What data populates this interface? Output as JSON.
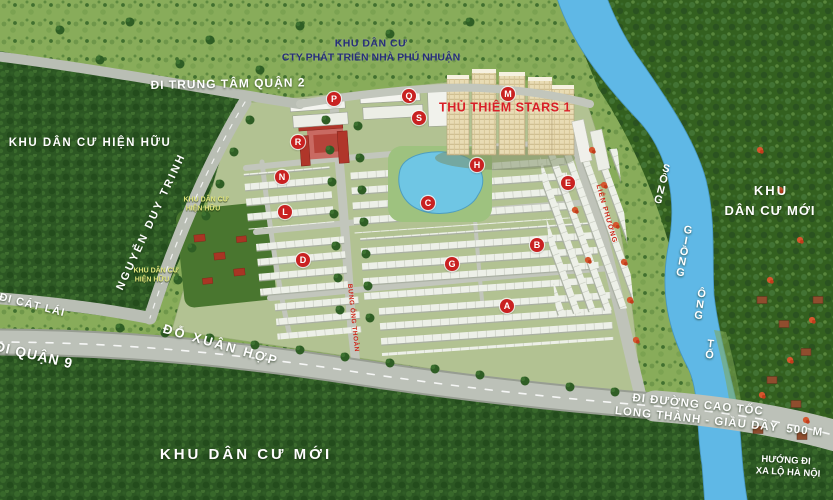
{
  "colors": {
    "marker_red": "#c92121",
    "river_blue": "#5fb8e6",
    "label_white": "#ffffff",
    "label_navy": "#272e7a",
    "label_yellow": "#e2e67c",
    "project_red": "#d81f26",
    "road_gray": "#bdc1ba",
    "forest_green": "#2c5723",
    "grass_green": "#88ac5a"
  },
  "labels": {
    "top_area_line1": "KHU DÂN CƯ",
    "top_area_line2": "CTY PHÁT TRIỂN NHÀ PHÚ NHUẬN",
    "to_district2": "ĐI TRUNG TÂM QUẬN 2",
    "existing_left": "KHU DÂN CƯ HIỆN HỮU",
    "nguyen_duy_trinh": "NGUYỄN DUY TRINH",
    "existing_small_1a": "KHU DÂN CƯ",
    "existing_small_1b": "HIỆN HỮU",
    "existing_small_2a": "KHU DÂN CƯ",
    "existing_small_2b": "HIỆN HỮU",
    "to_cat_lai": "ĐI CÁT LÁI",
    "to_district9": "ĐI QUẬN 9",
    "do_xuan_hop": "ĐỖ XUÂN HỢP",
    "new_area_bottom": "KHU DÂN CƯ MỚI",
    "new_area_right_1": "KHU",
    "new_area_right_2": "DÂN CƯ MỚI",
    "river_w1": "SÔNG",
    "river_w2": "GIỒNG",
    "river_w3": "ÔNG",
    "river_w4": "TỐ",
    "highway_line1": "ĐI ĐƯỜNG CAO TỐC",
    "highway_line2": "LONG THÀNH - GIẦU DÂY  500 M",
    "hanoi_line1": "HƯỚNG ĐI",
    "hanoi_line2": "XA LỘ HÀ NỘI",
    "project_name": "THỦ THIÊM STARS 1",
    "road_red_1": "LIÊN PHƯỜNG",
    "road_red_2": "BƯNG ÔNG THOÀN"
  },
  "markers": [
    {
      "letter": "M",
      "x": 508,
      "y": 94
    },
    {
      "letter": "P",
      "x": 334,
      "y": 99
    },
    {
      "letter": "Q",
      "x": 409,
      "y": 96
    },
    {
      "letter": "S",
      "x": 419,
      "y": 118
    },
    {
      "letter": "R",
      "x": 298,
      "y": 142
    },
    {
      "letter": "H",
      "x": 477,
      "y": 165
    },
    {
      "letter": "N",
      "x": 282,
      "y": 177
    },
    {
      "letter": "E",
      "x": 568,
      "y": 183
    },
    {
      "letter": "C",
      "x": 428,
      "y": 203
    },
    {
      "letter": "L",
      "x": 285,
      "y": 212
    },
    {
      "letter": "B",
      "x": 537,
      "y": 245
    },
    {
      "letter": "D",
      "x": 303,
      "y": 260
    },
    {
      "letter": "G",
      "x": 452,
      "y": 264
    },
    {
      "letter": "A",
      "x": 507,
      "y": 306
    }
  ]
}
